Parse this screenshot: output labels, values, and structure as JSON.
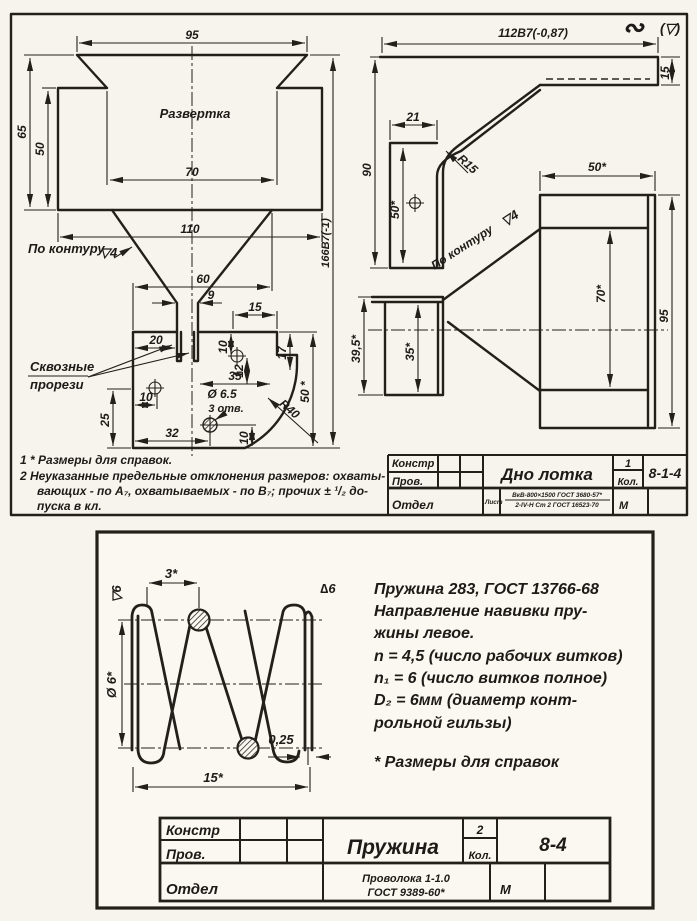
{
  "page": {
    "background": "#f6f4ed",
    "ink": "#22201b",
    "paper": "#faf8f1"
  },
  "sheet1": {
    "corner_mark": "∾",
    "corner_mark_paren": "(▽)",
    "development": {
      "title": "Развертка",
      "contour_note": "По контуру",
      "contour_flag": "▽4",
      "slots_note_line1": "Сквозные",
      "slots_note_line2": "прорези",
      "dim_95": "95",
      "dim_65": "65",
      "dim_50": "50",
      "dim_70": "70",
      "dim_110": "110",
      "dim_60": "60",
      "dim_9": "9",
      "dim_15": "15",
      "dim_20": "20",
      "dim_10_tab": "10",
      "dim_12": "12",
      "dim_17": "17",
      "dim_35": "35",
      "dim_50_star": "50 *",
      "dim_25": "25",
      "dim_10_left": "10",
      "dim_32": "32",
      "dim_10_bottom": "10",
      "dim_hole": "Ø 6.5",
      "dim_hole_qty": "3 отв.",
      "dim_r40": "R40",
      "dim_height": "166В7(-1)"
    },
    "profile": {
      "dim_width": "112В7(-0,87)",
      "dim_15": "15",
      "dim_21": "21",
      "dim_90": "90",
      "dim_50_star": "50*",
      "dim_r15": "R15",
      "contour_note": "По контуру",
      "contour_flag": "▽4",
      "dim_50_star_b": "50*",
      "dim_70_star": "70*",
      "dim_95": "95",
      "dim_39_5": "39,5*",
      "dim_35_star": "35*"
    },
    "notes": {
      "line1": "1 *   Размеры для справок.",
      "line2": "2   Неуказанные предельные отклонения размеров: охваты-",
      "line3": "вающих - по А₇, охватываемых - по В₇;  прочих ± ¹/₂ до-",
      "line4": "пуска в кл."
    },
    "title_block": {
      "row1": "Констр",
      "row2": "Пров.",
      "row3": "Отдел",
      "title": "Дно лотка",
      "qty_value": "1",
      "qty_label": "Кол.",
      "doc_number": "8-1-4",
      "material_label": "Лист",
      "material_line1": "ВкВ-800×1500 ГОСТ 3680-57*",
      "material_line2": "2-IV-Н Ст 2 ГОСТ 16523-70",
      "scale": "М"
    }
  },
  "sheet2": {
    "spring": {
      "dim_3": "3*",
      "rough_left": "▽6",
      "rough_right": "∆6",
      "dim_d6": "Ø 6*",
      "dim_025": "0,25",
      "dim_15": "15*"
    },
    "spec": {
      "line1": "Пружина 283, ГОСТ 13766-68",
      "line2": "Направление навивки пру-",
      "line3": "жины левое.",
      "line4": "n = 4,5 (число рабочих витков)",
      "line5": "n₁ = 6 (число витков полное)",
      "line6": "D₂ = 6мм (диаметр конт-",
      "line7": "рольной гильзы)",
      "footnote": "*   Размеры для справок"
    },
    "title_block": {
      "row1": "Констр",
      "row2": "Пров.",
      "row3": "Отдел",
      "title": "Пружина",
      "qty_value": "2",
      "qty_label": "Кол.",
      "doc_number": "8-4",
      "material_line1": "Проволока 1-1.0",
      "material_line2": "ГОСТ 9389-60*",
      "scale": "М"
    }
  }
}
